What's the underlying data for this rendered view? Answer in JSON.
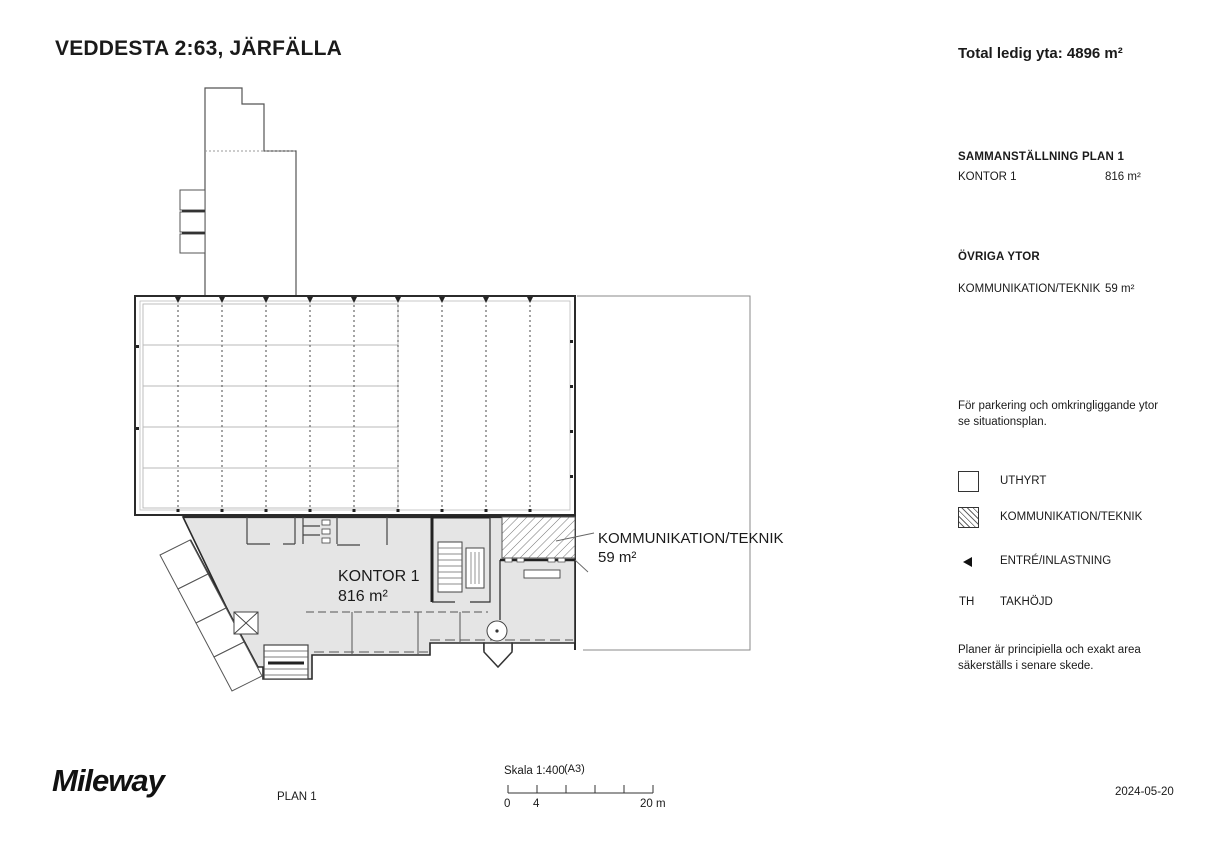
{
  "header": {
    "title": "VEDDESTA 2:63, JÄRFÄLLA",
    "total_label": "Total ledig yta: 4896 m²"
  },
  "sidebar": {
    "summary": {
      "heading": "SAMMANSTÄLLNING PLAN 1",
      "rows": [
        {
          "label": "KONTOR 1",
          "value": "816 m²"
        }
      ]
    },
    "other": {
      "heading": "ÖVRIGA YTOR",
      "rows": [
        {
          "label": "KOMMUNIKATION/TEKNIK",
          "value": "59 m²"
        }
      ]
    },
    "parking_note": "För parkering och omkringliggande ytor se situationsplan.",
    "legend": {
      "items": [
        {
          "swatch": "uthyrt-box",
          "label": "UTHYRT"
        },
        {
          "swatch": "hatched-box",
          "label": "KOMMUNIKATION/TEKNIK"
        },
        {
          "swatch": "entry-arrow",
          "label": "ENTRÉ/INLASTNING"
        },
        {
          "swatch": "text",
          "prefix": "TH",
          "label": "TAKHÖJD"
        }
      ]
    },
    "disclaimer": "Planer är principiella och exakt area säkerställs i senare skede."
  },
  "plan": {
    "kontor_label": "KONTOR 1",
    "kontor_area": "816 m²",
    "komm_label": "KOMMUNIKATION/TEKNIK",
    "komm_area": "59 m²"
  },
  "footer": {
    "logo": "Mileway",
    "plan_name": "PLAN 1",
    "scale_label": "Skala 1:400",
    "paper": "(A3)",
    "tick_start": "0",
    "tick_first": "4",
    "tick_end": "20 m",
    "date": "2024-05-20"
  },
  "colors": {
    "wall": "#2b2b2b",
    "area_fill": "#e5e5e5",
    "light_line": "#9a9a9a"
  }
}
